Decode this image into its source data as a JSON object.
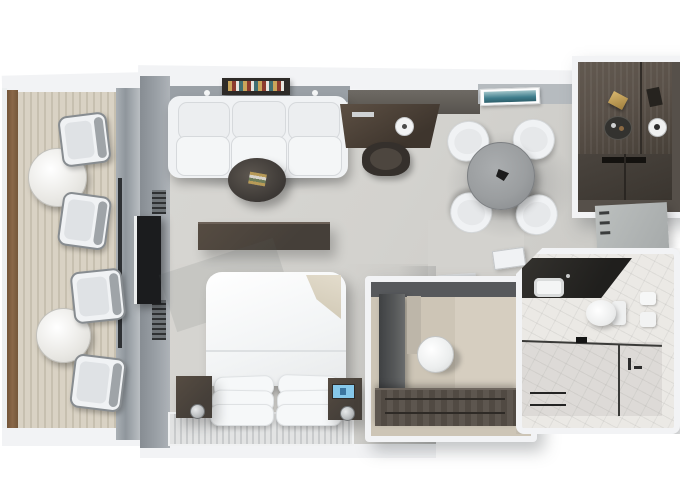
{
  "scene": {
    "title": "Suite floor plan - photorealistic top-down 3D rendering",
    "background": "white",
    "visible_text": "none"
  },
  "palette": {
    "bg": "#ffffff",
    "carpet": "#d3d2ce",
    "carpet-dark": "#c2c1bd",
    "balcony-floor": "#d9d2c4",
    "balcony-plank": "#c7c0b0",
    "wood-rail": "#8a6848",
    "wall-gray": "#9aa0a6",
    "wall-light": "#b6bbbf",
    "white-band": "#f2f3f5",
    "furn-white": "#f0f2f4",
    "cushion": "#dfe2e5",
    "wood-dark": "#453f39",
    "wood-medium": "#5a5149",
    "charcoal": "#2b2a28",
    "marble": "#ebe9e5",
    "table-gray": "#9b9ea0",
    "art-teal": "#3f7d8c",
    "clock-blue": "#86c8ea",
    "lamp-silver": "#b9bcbe",
    "tv-black": "#1b1c1e",
    "closet-floor": "#cdc5b6",
    "dark-wall": "#57595c"
  },
  "rooms": [
    {
      "id": "balcony",
      "name": "Balcony",
      "furniture": [
        "round table",
        "2 armchairs",
        "round table",
        "2 armchairs",
        "wood railing",
        "sliding glass door"
      ]
    },
    {
      "id": "living",
      "name": "Living Room",
      "furniture": [
        "3-seat white sofa",
        "book ledge",
        "wall sconces",
        "oval coffee table",
        "dark wood console"
      ]
    },
    {
      "id": "work",
      "name": "Desk Area",
      "furniture": [
        "dark wood desk",
        "desk chair",
        "desk clock"
      ]
    },
    {
      "id": "dining",
      "name": "Dining Area",
      "furniture": [
        "round gray table",
        "4 white chairs",
        "teal wall art"
      ]
    },
    {
      "id": "bar",
      "name": "Bar Pantry",
      "furniture": [
        "dark wood counter with trays and bottles",
        "lower cabinets"
      ]
    },
    {
      "id": "bedroom",
      "name": "Bedroom",
      "furniture": [
        "king bed with white duvet",
        "6 pillows",
        "beige throw",
        "2 nightstands",
        "lamps",
        "alarm clock",
        "wall TV",
        "ribbed headboard bench"
      ]
    },
    {
      "id": "closet",
      "name": "Walk-in Closet",
      "furniture": [
        "wardrobe column",
        "round vanity stool",
        "drawer bank"
      ]
    },
    {
      "id": "bathroom",
      "name": "Bathroom",
      "furniture": [
        "dark stone vanity",
        "white sink",
        "toilet",
        "glass shower partition",
        "towel rail",
        "wall towels"
      ]
    },
    {
      "id": "hall",
      "name": "Entry Hall",
      "furniture": [
        "wall shelves",
        "tall cabinet",
        "entry door"
      ]
    }
  ]
}
